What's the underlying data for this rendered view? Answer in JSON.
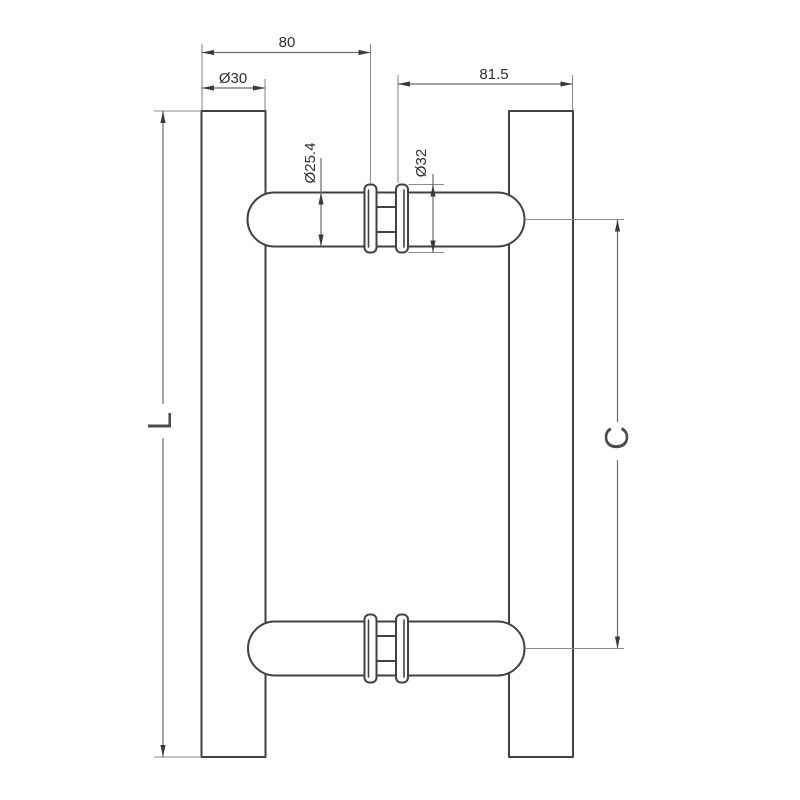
{
  "drawing": {
    "type": "technical-drawing",
    "subject": "Back-to-back door pull handle, side elevation with dimensions",
    "colors": {
      "background": "#ffffff",
      "outline": "#414141",
      "dimension_line": "#6b6b6b",
      "extension_line": "#8c8c8c",
      "arrow": "#3a3a3a",
      "text": "#2f2f2f",
      "label_text": "#4a4a4a"
    },
    "dimensions": {
      "top_offset": "80",
      "post_diameter": "Ø30",
      "right_offset": "81.5",
      "grip_diameter": "Ø25.4",
      "rose_diameter": "Ø32",
      "overall_length": "L",
      "center_to_center": "C"
    }
  }
}
